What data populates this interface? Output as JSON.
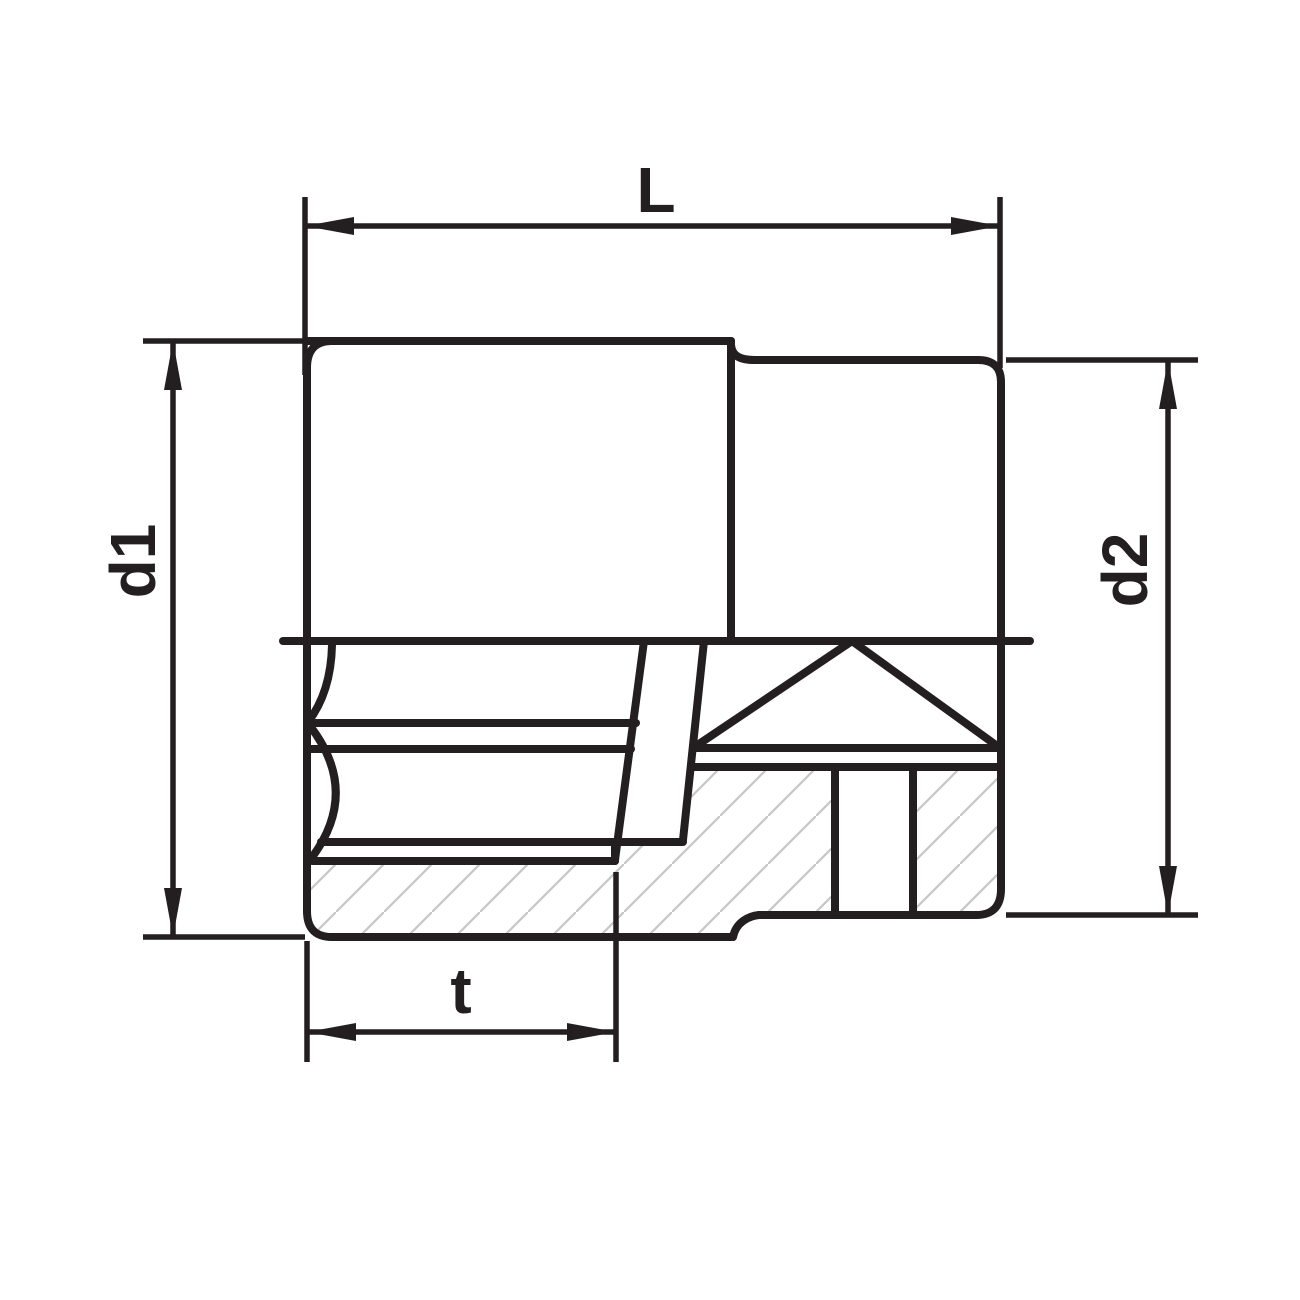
{
  "drawing": {
    "title": "Socket half-section technical drawing",
    "dimensions": {
      "length_label": "L",
      "front_diameter_label": "d1",
      "rear_diameter_label": "d2",
      "hex_depth_label": "t"
    },
    "colors": {
      "line": "#231f20",
      "hatch": "#c5c5c5",
      "background": "#ffffff"
    }
  }
}
